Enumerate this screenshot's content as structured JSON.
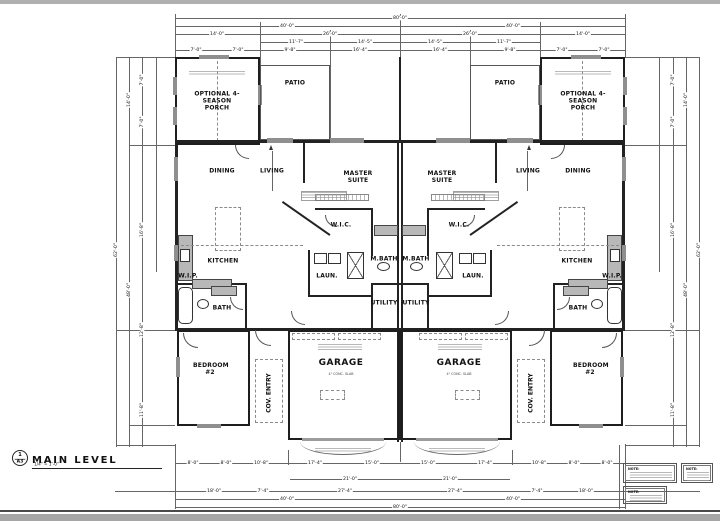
{
  "sheet": {
    "view_number": "1",
    "sheet_ref": "A3",
    "view_title": "MAIN LEVEL",
    "view_scale": "1/4\" = 1'-0\""
  },
  "units": {
    "left": {
      "porch": "OPTIONAL 4-SEASON PORCH",
      "patio": "PATIO",
      "dining": "DINING",
      "living": "LIVING",
      "master_suite": "MASTER SUITE",
      "wic": "W.I.C.",
      "kitchen": "KITCHEN",
      "wip": "W.I.P.",
      "laundry": "LAUN.",
      "master_bath": "M.BATH",
      "utility": "UTILITY",
      "bath": "BATH",
      "bedroom2": "BEDROOM #2",
      "garage": "GARAGE",
      "garage_note": "4\" CONC. SLAB",
      "cov_entry": "COV. ENTRY"
    },
    "right": {
      "porch": "OPTIONAL 4-SEASON PORCH",
      "patio": "PATIO",
      "dining": "DINING",
      "living": "LIVING",
      "master_suite": "MASTER SUITE",
      "wic": "W.I.C.",
      "kitchen": "KITCHEN",
      "wip": "W.I.P.",
      "laundry": "LAUN.",
      "master_bath": "M.BATH",
      "utility": "UTILITY",
      "bath": "BATH",
      "bedroom2": "BEDROOM #2",
      "garage": "GARAGE",
      "garage_note": "4\" CONC. SLAB",
      "cov_entry": "COV. ENTRY"
    }
  },
  "dims": {
    "top": [
      "80'-0\"",
      "40'-0\"",
      "40'-0\"",
      "14'-0\"",
      "26'-0\"",
      "26'-0\"",
      "14'-0\"",
      "11'-7\"",
      "14'-5\"",
      "14'-5\"",
      "11'-7\"",
      "7'-0\"",
      "7'-0\"",
      "9'-8\"",
      "16'-4\"",
      "16'-4\"",
      "9'-8\"",
      "7'-0\"",
      "7'-0\""
    ],
    "bottom": [
      "8'-0\"",
      "8'-0\"",
      "10'-8\"",
      "17'-4\"",
      "15'-0\"",
      "15'-0\"",
      "17'-4\"",
      "10'-8\"",
      "8'-0\"",
      "8'-0\"",
      "21'-0\"",
      "21'-0\"",
      "18'-0\"",
      "7'-4\"",
      "27'-4\"",
      "27'-4\"",
      "7'-4\"",
      "18'-0\"",
      "40'-0\"",
      "40'-0\"",
      "80'-0\""
    ],
    "left_side": [
      "62'-0\"",
      "14'-0\"",
      "48'-0\"",
      "7'-0\"",
      "7'-0\"",
      "16'-8\"",
      "12'-8\"",
      "11'-8\""
    ],
    "right_side": [
      "62'-0\"",
      "14'-0\"",
      "48'-0\"",
      "7'-0\"",
      "7'-0\"",
      "16'-8\"",
      "12'-8\"",
      "11'-8\""
    ]
  },
  "notes": {
    "a": "NOTE:",
    "b": "NOTE:",
    "c": "NOTE:"
  }
}
